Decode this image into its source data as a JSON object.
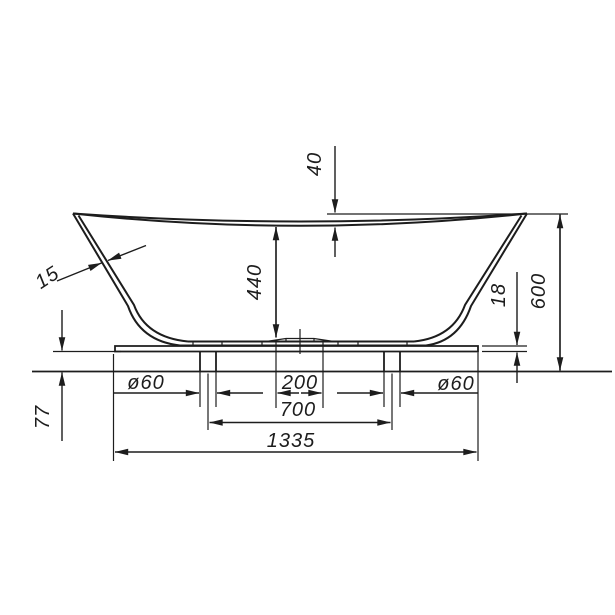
{
  "drawing": {
    "ink_color": "#1d1d1d",
    "background_color": "#ffffff"
  },
  "dims": {
    "rim_drop": "40",
    "inner_depth": "440",
    "wall_thickness": "15",
    "plate_thickness": "18",
    "overall_height": "600",
    "dia_left": "ø60",
    "drain_zone": "200",
    "leg_span": "700",
    "dia_right": "ø60",
    "overall_length": "1335",
    "base_height": "77"
  }
}
